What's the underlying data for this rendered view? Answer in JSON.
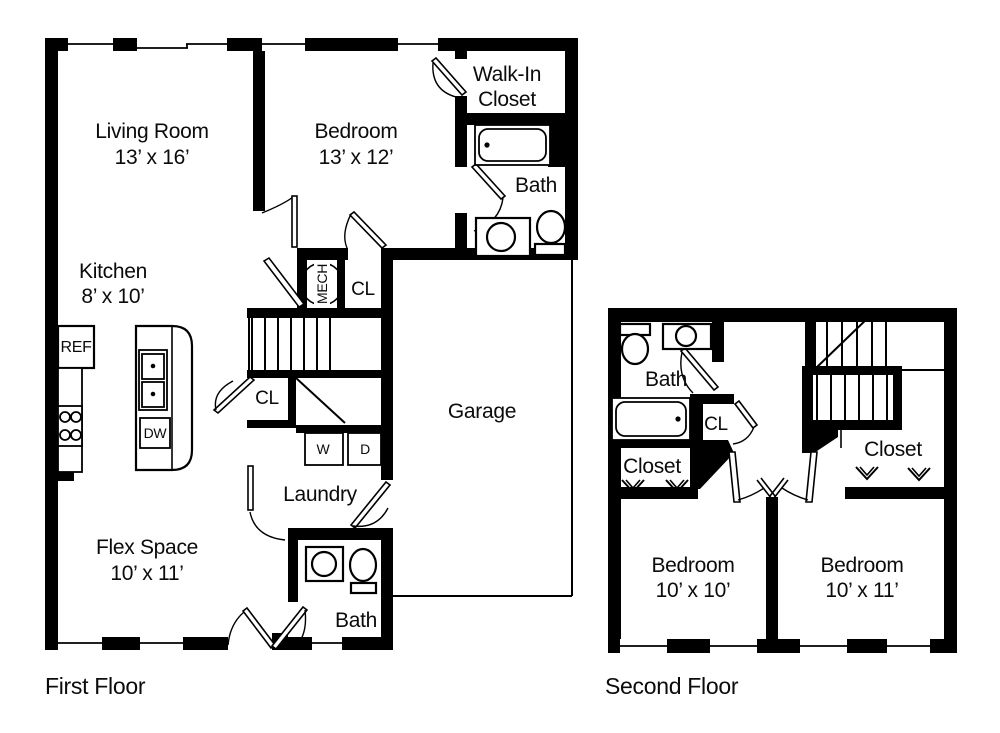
{
  "first_floor": {
    "title": "First Floor",
    "living_room": {
      "name": "Living Room",
      "dims": "13’ x 16’"
    },
    "bedroom": {
      "name": "Bedroom",
      "dims": "13’ x 12’"
    },
    "walk_in_closet": {
      "line1": "Walk-In",
      "line2": "Closet"
    },
    "bath_upper": "Bath",
    "kitchen": {
      "name": "Kitchen",
      "dims": "8’ x 10’"
    },
    "fixtures": {
      "ref": "REF",
      "dw": "DW",
      "mech": "MECH",
      "washer": "W",
      "dryer": "D"
    },
    "closet_upper": "CL",
    "closet_lower": "CL",
    "laundry": "Laundry",
    "flex_space": {
      "name": "Flex Space",
      "dims": "10’ x 11’"
    },
    "bath_lower": "Bath",
    "garage": "Garage"
  },
  "second_floor": {
    "title": "Second Floor",
    "bath": "Bath",
    "closet_small": "CL",
    "closet_left": "Closet",
    "closet_right": "Closet",
    "bedroom_left": {
      "name": "Bedroom",
      "dims": "10’ x 10’"
    },
    "bedroom_right": {
      "name": "Bedroom",
      "dims": "10’ x 11’"
    }
  }
}
